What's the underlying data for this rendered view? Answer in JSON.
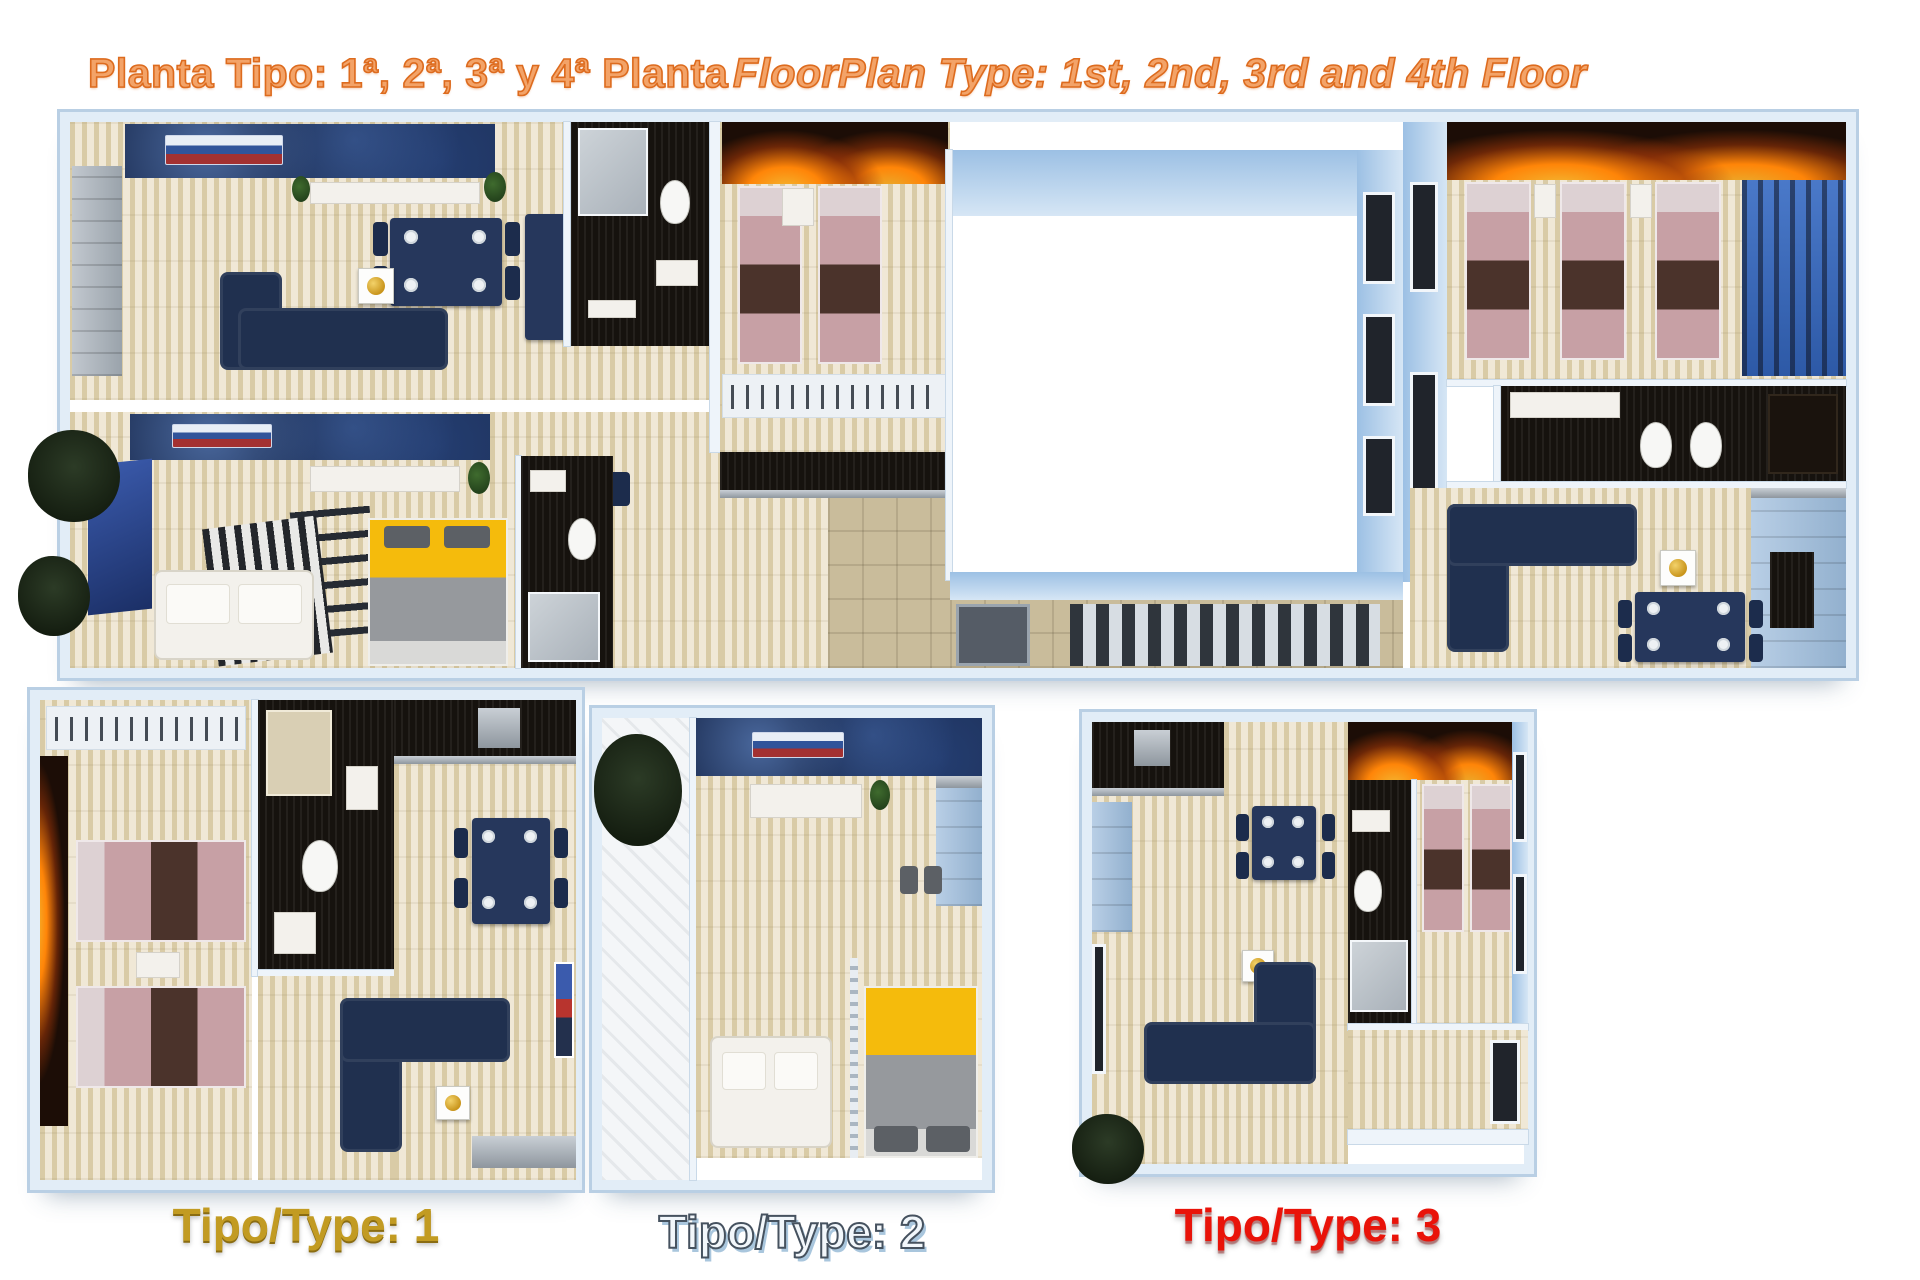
{
  "header": {
    "title_left": "Planta Tipo: 1ª, 2ª, 3ª y 4ª Planta",
    "title_right": "FloorPlan Type: 1st, 2nd, 3rd and 4th Floor"
  },
  "plans": {
    "main": {
      "description_names": [
        "apartment-top-left",
        "apartment-bottom-left",
        "twin-bedroom-center",
        "central-lightwell",
        "stair-corridor",
        "apartment-right"
      ]
    },
    "type1": {
      "label": "Tipo/Type: 1"
    },
    "type2": {
      "label": "Tipo/Type: 2"
    },
    "type3": {
      "label": "Tipo/Type: 3"
    }
  },
  "palette": {
    "title_fill": "#f3a368",
    "title_stroke": "#dd6b1e",
    "label1": "#c29b22",
    "label1_shadow": "#8a6c12",
    "label2_fill": "#f2f7fb",
    "label2_stroke": "#46525f",
    "label2_shadow": "#a9c6dd",
    "label3": "#e91309",
    "floor_light": "#f0e8d6",
    "floor_dark": "#d9cba6",
    "wall_blue": "#9cc0e4",
    "wall_blue_light": "#d6e6f5",
    "navy": "#1d2f55",
    "navy_sofa": "#20304f",
    "pink": "#c7a0a5",
    "blanket": "#4b332b",
    "pillow": "#ddd1d3",
    "fire_glow": "#ff8508",
    "fire_base": "#1c0d06",
    "yellow": "#f5bb0c",
    "black_tile": "#16120e",
    "steel_light": "#c9cfd5",
    "steel_dark": "#8e969e",
    "cab_blue_1": "#b9cfe6",
    "cab_blue_2": "#92b0ce",
    "white_furn": "#f3f1ec",
    "gold": "#c9951c",
    "plant_green": "#3f6b2e",
    "plant_dark": "#141d10"
  }
}
